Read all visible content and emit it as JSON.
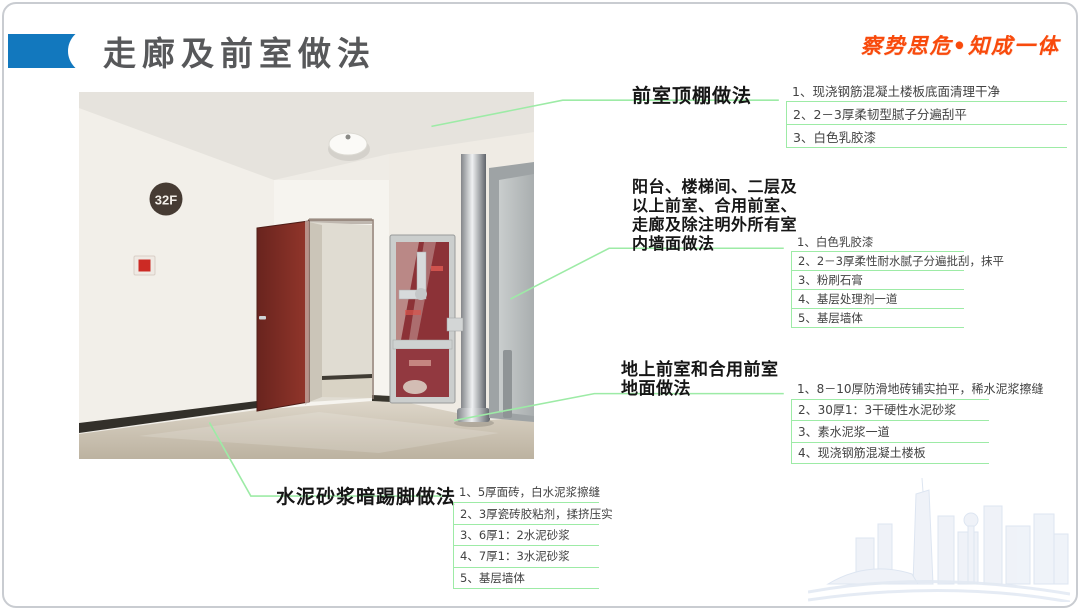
{
  "header": {
    "title": "走廊及前室做法",
    "motto": "察势思危•知成一体"
  },
  "photo": {
    "floor_sign": "32F"
  },
  "callouts": {
    "ceiling": {
      "title": "前室顶棚做法",
      "items": [
        "1、现浇钢筋混凝土楼板底面清理干净",
        "2、2－3厚柔韧型腻子分遍刮平",
        "3、白色乳胶漆"
      ]
    },
    "wall": {
      "title_lines": [
        "阳台、楼梯间、二层及",
        "以上前室、合用前室、",
        "走廊及除注明外所有室",
        "内墙面做法"
      ],
      "items": [
        "1、白色乳胶漆",
        "2、2－3厚柔性耐水腻子分遍批刮，抹平",
        "3、粉刷石膏",
        "4、基层处理剂一道",
        "5、基层墙体"
      ]
    },
    "floor": {
      "title_lines": [
        "地上前室和合用前室",
        "地面做法"
      ],
      "items": [
        "1、8－10厚防滑地砖铺实拍平，稀水泥浆擦缝",
        "2、30厚1：3干硬性水泥砂浆",
        "3、素水泥浆一道",
        "4、现浇钢筋混凝土楼板"
      ]
    },
    "skirting": {
      "title": "水泥砂浆暗踢脚做法",
      "items": [
        "1、5厚面砖，白水泥浆擦缝",
        "2、3厚瓷砖胶粘剂，揉挤压实",
        "3、6厚1：2水泥砂浆",
        "4、7厚1：3水泥砂浆",
        "5、基层墙体"
      ]
    }
  },
  "colors": {
    "accent_blue": "#1278be",
    "leader_green": "#9deba6",
    "motto_orange": "#f84a0c",
    "title_gray": "#57585a"
  }
}
